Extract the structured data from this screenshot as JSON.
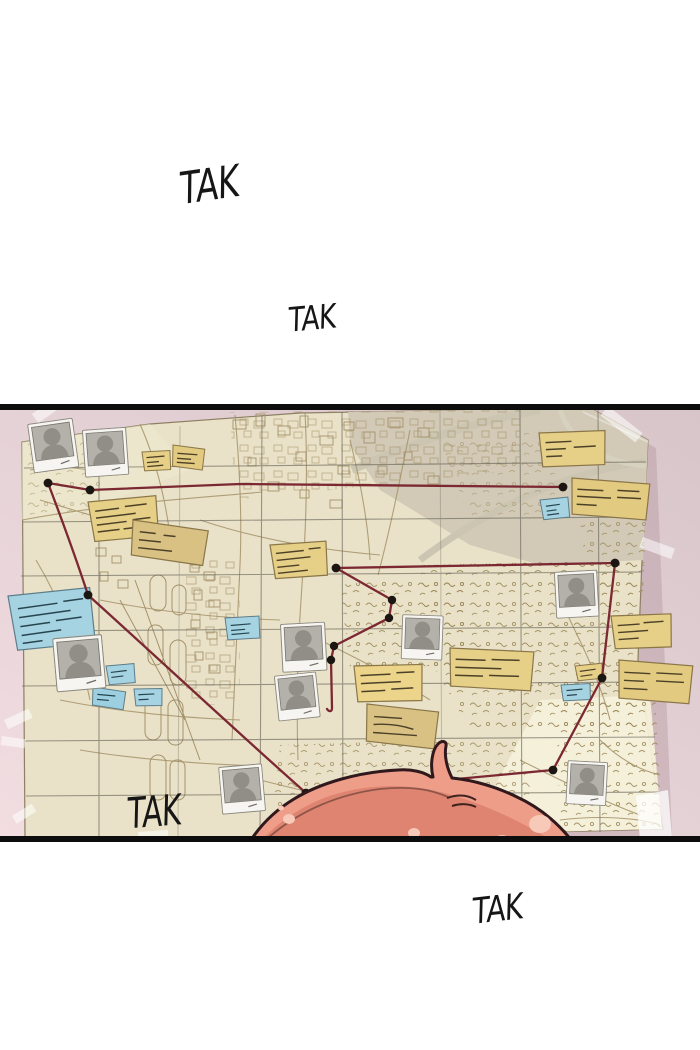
{
  "sfx": [
    {
      "text": "TAK",
      "position": "top-left"
    },
    {
      "text": "TAK",
      "position": "upper-center"
    },
    {
      "text": "TAK",
      "position": "board-bottom-left"
    },
    {
      "text": "TAK",
      "position": "bottom-right"
    }
  ],
  "panel": {
    "kind": "webtoon-investigation-board",
    "board": {
      "wall_color": "#ddcbcf",
      "map_paper_color": "#e9e2c8",
      "map_ink_color": "#a5926a",
      "string_color": "#7b2832",
      "note_yellow_color": "#e6cf86",
      "note_tan_color": "#d9c184",
      "note_blue_color": "#a6d3e1",
      "hair_color": "#ee9d88",
      "photo_count": 9,
      "yellow_note_count": 13,
      "blue_note_count": 7,
      "pin_count": 13
    }
  }
}
